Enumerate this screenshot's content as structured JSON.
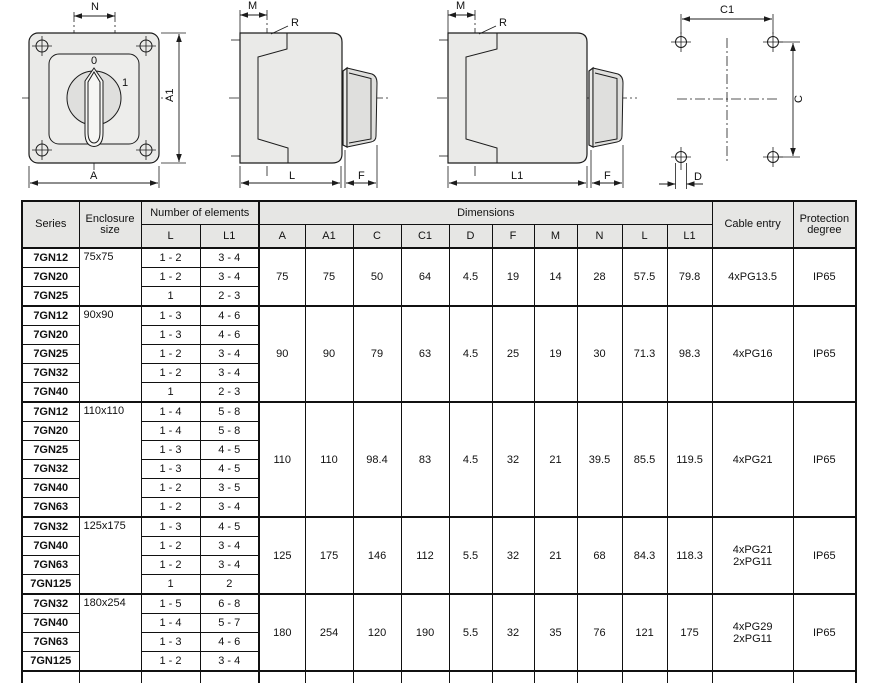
{
  "colors": {
    "line": "#1c1c1c",
    "body_fill": "#eaeae8",
    "header_bg": "#e6e6e4",
    "text": "#111111"
  },
  "drawings": {
    "front_view": {
      "n": "N",
      "a": "A",
      "a1": "A1",
      "pos_off": "0",
      "pos_on": "1"
    },
    "side_l": {
      "m": "M",
      "r": "R",
      "l": "L",
      "f": "F"
    },
    "side_l1": {
      "m": "M",
      "r": "R",
      "l1": "L1",
      "f": "F"
    },
    "drill": {
      "c1": "C1",
      "c": "C",
      "d": "D"
    }
  },
  "table": {
    "headers": {
      "series": "Series",
      "enclosure": "Enclosure size",
      "elements": "Number of elements",
      "dimensions": "Dimensions",
      "cable": "Cable entry",
      "protection": "Protection degree",
      "sub": [
        "L",
        "L1",
        "A",
        "A1",
        "C",
        "C1",
        "D",
        "F",
        "M",
        "N",
        "L",
        "L1"
      ]
    },
    "groups": [
      {
        "enclosure": "75x75",
        "rows": [
          {
            "series": "7GN12",
            "l": "1 - 2",
            "l1": "3 - 4"
          },
          {
            "series": "7GN20",
            "l": "1 - 2",
            "l1": "3 - 4"
          },
          {
            "series": "7GN25",
            "l": "1",
            "l1": "2 - 3"
          }
        ],
        "dims": [
          "75",
          "75",
          "50",
          "64",
          "4.5",
          "19",
          "14",
          "28",
          "57.5",
          "79.8"
        ],
        "cable": "4xPG13.5",
        "protection": "IP65"
      },
      {
        "enclosure": "90x90",
        "rows": [
          {
            "series": "7GN12",
            "l": "1 - 3",
            "l1": "4 - 6"
          },
          {
            "series": "7GN20",
            "l": "1 - 3",
            "l1": "4 - 6"
          },
          {
            "series": "7GN25",
            "l": "1 - 2",
            "l1": "3 - 4"
          },
          {
            "series": "7GN32",
            "l": "1 - 2",
            "l1": "3 - 4"
          },
          {
            "series": "7GN40",
            "l": "1",
            "l1": "2 - 3"
          }
        ],
        "dims": [
          "90",
          "90",
          "79",
          "63",
          "4.5",
          "25",
          "19",
          "30",
          "71.3",
          "98.3"
        ],
        "cable": "4xPG16",
        "protection": "IP65"
      },
      {
        "enclosure": "110x110",
        "rows": [
          {
            "series": "7GN12",
            "l": "1 - 4",
            "l1": "5 - 8"
          },
          {
            "series": "7GN20",
            "l": "1 - 4",
            "l1": "5 - 8"
          },
          {
            "series": "7GN25",
            "l": "1 - 3",
            "l1": "4 - 5"
          },
          {
            "series": "7GN32",
            "l": "1 - 3",
            "l1": "4 - 5"
          },
          {
            "series": "7GN40",
            "l": "1 - 2",
            "l1": "3 - 5"
          },
          {
            "series": "7GN63",
            "l": "1 - 2",
            "l1": "3 - 4"
          }
        ],
        "dims": [
          "110",
          "110",
          "98.4",
          "83",
          "4.5",
          "32",
          "21",
          "39.5",
          "85.5",
          "119.5"
        ],
        "cable": "4xPG21",
        "protection": "IP65"
      },
      {
        "enclosure": "125x175",
        "rows": [
          {
            "series": "7GN32",
            "l": "1 - 3",
            "l1": "4 - 5"
          },
          {
            "series": "7GN40",
            "l": "1 - 2",
            "l1": "3 - 4"
          },
          {
            "series": "7GN63",
            "l": "1 - 2",
            "l1": "3 - 4"
          },
          {
            "series": "7GN125",
            "l": "1",
            "l1": "2"
          }
        ],
        "dims": [
          "125",
          "175",
          "146",
          "112",
          "5.5",
          "32",
          "21",
          "68",
          "84.3",
          "118.3"
        ],
        "cable": "4xPG21\n2xPG11",
        "protection": "IP65"
      },
      {
        "enclosure": "180x254",
        "rows": [
          {
            "series": "7GN32",
            "l": "1 - 5",
            "l1": "6 - 8"
          },
          {
            "series": "7GN40",
            "l": "1 - 4",
            "l1": "5 - 7"
          },
          {
            "series": "7GN63",
            "l": "1 - 3",
            "l1": "4 - 6"
          },
          {
            "series": "7GN125",
            "l": "1 - 2",
            "l1": "3 - 4"
          }
        ],
        "dims": [
          "180",
          "254",
          "120",
          "190",
          "5.5",
          "32",
          "35",
          "76",
          "121",
          "175"
        ],
        "cable": "4xPG29\n2xPG11",
        "protection": "IP65"
      }
    ]
  }
}
